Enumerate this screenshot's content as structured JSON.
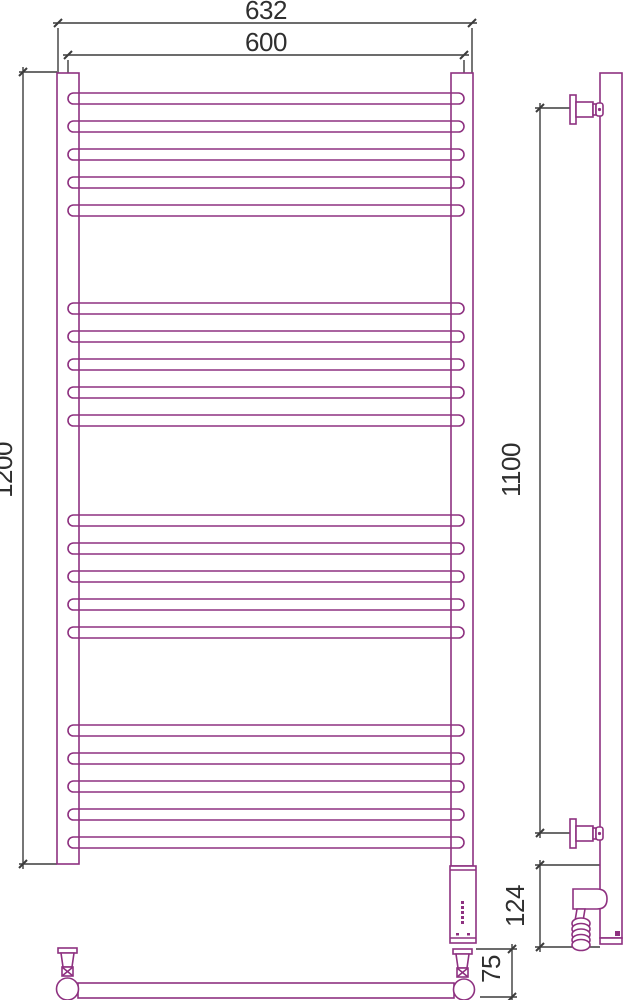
{
  "drawing": {
    "kind": "technical dimension drawing",
    "subject": "ladder heated towel rail, front and side views"
  },
  "dimensions": {
    "overall_width": "632",
    "bar_width": "600",
    "overall_height": "1200",
    "bracket_spacing": "1100",
    "heater_section_height": "124",
    "bottom_offset": "75"
  },
  "colors": {
    "outline": "#8e3180",
    "dimension_lines": "#3c3c3c",
    "background": "#ffffff"
  },
  "front_view": {
    "bar_groups": 4,
    "bars_per_group": 5,
    "total_bars": 20,
    "bars": {
      "x": 68,
      "width": 396,
      "height": 11,
      "rx": 5.5,
      "tops": [
        93,
        121,
        149,
        177,
        205,
        303,
        331,
        359,
        387,
        415,
        515,
        543,
        571,
        599,
        627,
        725,
        753,
        781,
        809,
        837
      ]
    }
  },
  "side_view": {
    "coil": {
      "cx": 581,
      "rx": 9,
      "ry": 5.5,
      "cys": [
        923.5,
        929,
        934.5,
        940,
        945
      ]
    }
  }
}
